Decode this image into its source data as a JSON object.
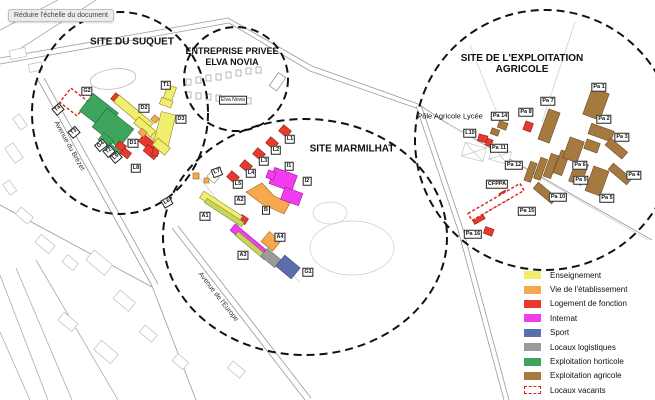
{
  "viewer": {
    "tooltip": "Réduire l'échelle du document"
  },
  "map": {
    "site_titles": [
      {
        "id": "suquet",
        "lines": [
          "SITE DU SUQUET"
        ],
        "x": 132,
        "y": 42
      },
      {
        "id": "elva-novia",
        "lines": [
          "ENTREPRISE PRIVEE",
          "ELVA NOVIA"
        ],
        "x": 232,
        "y": 57
      },
      {
        "id": "marmilhat",
        "lines": [
          "SITE MARMILHAT"
        ],
        "x": 352,
        "y": 149
      },
      {
        "id": "exploitation-agricole",
        "lines": [
          "SITE DE L'EXPLOITATION",
          "AGRICOLE"
        ],
        "x": 522,
        "y": 64
      }
    ],
    "streets": [
      {
        "name": "Avenue du Brézet",
        "x": 69,
        "y": 146,
        "rot": 61
      },
      {
        "name": "Avenue de l'Europe",
        "x": 218,
        "y": 297,
        "rot": 52
      }
    ],
    "poi_labels": [
      {
        "text": "Pôle Agricole Lycée",
        "x": 450,
        "y": 116
      }
    ],
    "building_labels": [
      {
        "text": "T1",
        "x": 166,
        "y": 85
      },
      {
        "text": "G2",
        "x": 87,
        "y": 91
      },
      {
        "text": "T4",
        "x": 58,
        "y": 109,
        "rot": -40
      },
      {
        "text": "D2",
        "x": 144,
        "y": 108
      },
      {
        "text": "D3",
        "x": 181,
        "y": 119
      },
      {
        "text": "T3",
        "x": 74,
        "y": 132,
        "rot": -40
      },
      {
        "text": "D1",
        "x": 133,
        "y": 143
      },
      {
        "text": "G4",
        "x": 101,
        "y": 145,
        "rot": -40
      },
      {
        "text": "T2",
        "x": 109,
        "y": 151,
        "rot": -40
      },
      {
        "text": "L9",
        "x": 116,
        "y": 157,
        "rot": -40
      },
      {
        "text": "L8",
        "x": 136,
        "y": 168
      },
      {
        "text": "L6",
        "x": 167,
        "y": 202,
        "rot": -30
      },
      {
        "text": "L7",
        "x": 217,
        "y": 172,
        "rot": -20
      },
      {
        "text": "L5",
        "x": 238,
        "y": 184
      },
      {
        "text": "L4",
        "x": 251,
        "y": 173
      },
      {
        "text": "L3",
        "x": 264,
        "y": 161
      },
      {
        "text": "L2",
        "x": 276,
        "y": 150
      },
      {
        "text": "L1",
        "x": 290,
        "y": 139
      },
      {
        "text": "I1",
        "x": 289,
        "y": 166
      },
      {
        "text": "I2",
        "x": 307,
        "y": 181
      },
      {
        "text": "A2",
        "x": 240,
        "y": 200
      },
      {
        "text": "B",
        "x": 266,
        "y": 210
      },
      {
        "text": "A1",
        "x": 205,
        "y": 216
      },
      {
        "text": "A4",
        "x": 280,
        "y": 237
      },
      {
        "text": "A3",
        "x": 243,
        "y": 255
      },
      {
        "text": "G1",
        "x": 308,
        "y": 272
      },
      {
        "text": "L10",
        "x": 470,
        "y": 133
      },
      {
        "text": "CFPPA",
        "x": 497,
        "y": 184
      },
      {
        "text": "Pa 1",
        "x": 599,
        "y": 87
      },
      {
        "text": "Pa 7",
        "x": 548,
        "y": 101
      },
      {
        "text": "Pa 8",
        "x": 526,
        "y": 112
      },
      {
        "text": "Pa 14",
        "x": 500,
        "y": 116
      },
      {
        "text": "Pa 2",
        "x": 604,
        "y": 119
      },
      {
        "text": "Pa 3",
        "x": 622,
        "y": 137
      },
      {
        "text": "Pa 11",
        "x": 499,
        "y": 148
      },
      {
        "text": "Pa 12",
        "x": 514,
        "y": 165
      },
      {
        "text": "Pa 6",
        "x": 580,
        "y": 165
      },
      {
        "text": "Pa 9",
        "x": 581,
        "y": 180
      },
      {
        "text": "Pa 4",
        "x": 634,
        "y": 175
      },
      {
        "text": "Pa 10",
        "x": 558,
        "y": 197
      },
      {
        "text": "Pa 5",
        "x": 607,
        "y": 198
      },
      {
        "text": "Pa 15",
        "x": 527,
        "y": 211
      },
      {
        "text": "Pa 16",
        "x": 473,
        "y": 234
      },
      {
        "text": "Elva Novia",
        "x": 233,
        "y": 100,
        "sm": true
      }
    ]
  },
  "legend": {
    "items": [
      {
        "label": "Enseignement",
        "color": "#f0ee6c"
      },
      {
        "label": "Vie de l'établissement",
        "color": "#f7a84e"
      },
      {
        "label": "Logement de fonction",
        "color": "#e8392e"
      },
      {
        "label": "Internat",
        "color": "#f23cf0"
      },
      {
        "label": "Sport",
        "color": "#5b6dac"
      },
      {
        "label": "Locaux logistiques",
        "color": "#9b9b9b"
      },
      {
        "label": "Exploitation horticole",
        "color": "#3ea55e"
      },
      {
        "label": "Exploitation agricole",
        "color": "#a5793f"
      },
      {
        "label": "Locaux vacants",
        "color": "#ffffff",
        "vacant": true
      }
    ]
  }
}
